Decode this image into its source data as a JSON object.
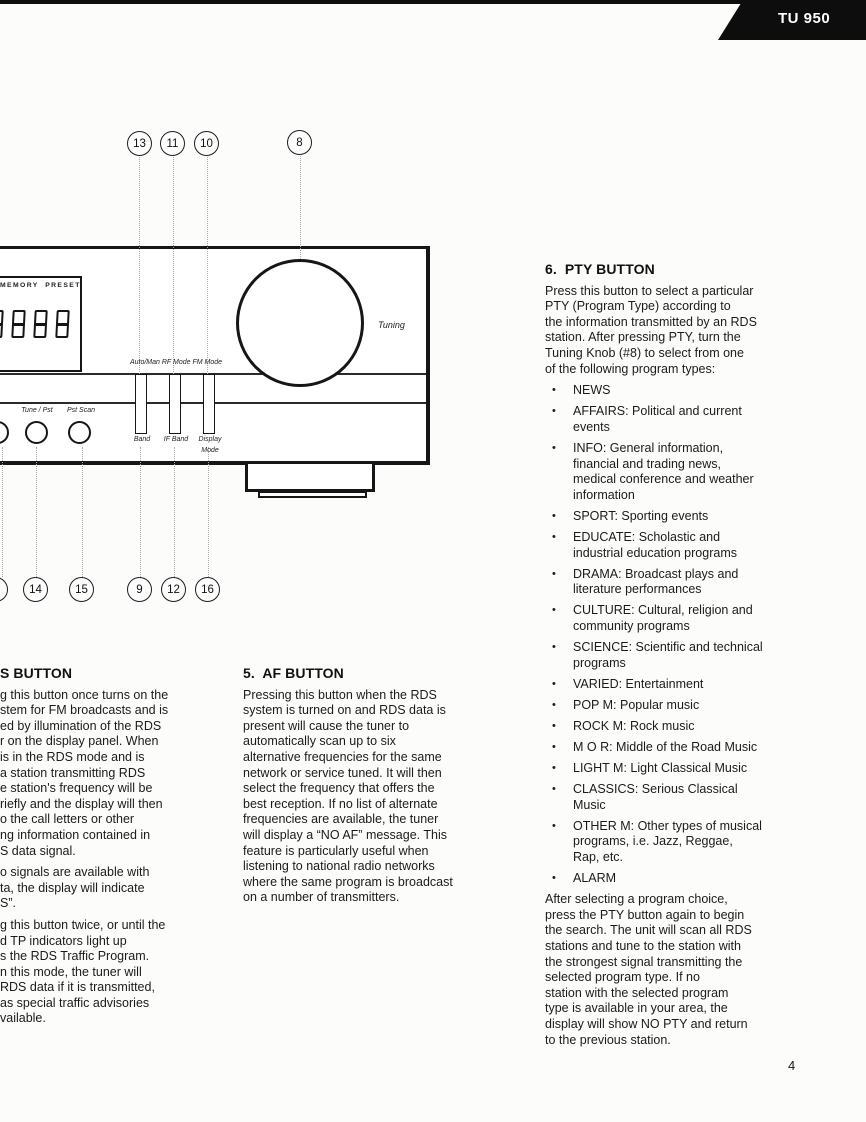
{
  "page": {
    "model_badge": "TU 950",
    "page_number": "4"
  },
  "diagram": {
    "callouts_top": [
      "13",
      "11",
      "10",
      "8"
    ],
    "callouts_bottom": [
      "14",
      "15",
      "9",
      "12",
      "16"
    ],
    "display_panel": {
      "memory_preset": "MEMORY  PRESET",
      "digits": "888"
    },
    "labels": {
      "tuning": "Tuning",
      "auto_man_rf_fm": "Auto/Man RF Mode FM Mode",
      "band": "Band",
      "if_band": "IF Band",
      "display_mode_line1": "Display",
      "display_mode_line2": "Mode",
      "tune_pst": "Tune / Pst",
      "pst_scan": "Pst Scan"
    }
  },
  "sections": {
    "rds_button": {
      "heading": "S BUTTON",
      "paragraphs": [
        [
          "g this button once turns on the",
          "stem for FM broadcasts and is",
          "ed by illumination of the RDS",
          "r on the display panel. When",
          "is in the RDS mode and is",
          "a station transmitting RDS",
          "e station's frequency will be",
          "riefly and the display will then",
          "o the call letters or other",
          "ng information contained in",
          "S data signal."
        ],
        [
          "o signals are available with",
          "ta, the display will indicate",
          "S”."
        ],
        [
          "g this button twice, or until the",
          "d TP indicators light up",
          "s the RDS Traffic Program.",
          "n this mode, the tuner will",
          "RDS data if it is transmitted,",
          "as special traffic advisories",
          "vailable."
        ]
      ]
    },
    "af_button": {
      "heading": "5.  AF BUTTON",
      "lines": [
        "Pressing this button when the RDS",
        "system is turned on and RDS data is",
        "present will cause the tuner to",
        "automatically scan up to six",
        "alternative frequencies for the same",
        "network or service tuned. It will then",
        "select the frequency that offers the",
        "best reception. If no list of alternate",
        "frequencies are available, the tuner",
        "will display a “NO AF” message. This",
        "feature is particularly useful when",
        "listening to national radio networks",
        "where the same program is broadcast",
        "on a number of transmitters."
      ]
    },
    "pty_button": {
      "heading": "6.  PTY BUTTON",
      "intro_lines": [
        "Press this button to select a particular",
        "PTY (Program Type) according to",
        "the information transmitted by an RDS",
        "station. After pressing PTY, turn the",
        "Tuning Knob (#8) to select from one",
        "of the following program types:"
      ],
      "bullets": [
        {
          "lines": [
            "NEWS"
          ]
        },
        {
          "lines": [
            "AFFAIRS: Political and current",
            "events"
          ]
        },
        {
          "lines": [
            "INFO: General information,",
            "financial and trading news,",
            "medical conference and weather",
            "information"
          ]
        },
        {
          "lines": [
            "SPORT: Sporting events"
          ]
        },
        {
          "lines": [
            "EDUCATE: Scholastic and",
            "industrial education programs"
          ]
        },
        {
          "lines": [
            "DRAMA: Broadcast plays and",
            "literature performances"
          ]
        },
        {
          "lines": [
            "CULTURE: Cultural, religion and",
            "community programs"
          ]
        },
        {
          "lines": [
            "SCIENCE: Scientific and technical",
            "programs"
          ]
        },
        {
          "lines": [
            "VARIED: Entertainment"
          ]
        },
        {
          "lines": [
            "POP M: Popular music"
          ]
        },
        {
          "lines": [
            "ROCK M: Rock music"
          ]
        },
        {
          "lines": [
            "M O R: Middle of the Road Music"
          ]
        },
        {
          "lines": [
            "LIGHT M: Light Classical Music"
          ]
        },
        {
          "lines": [
            "CLASSICS: Serious Classical",
            "Music"
          ]
        },
        {
          "lines": [
            "OTHER M: Other types of musical",
            "programs, i.e. Jazz, Reggae,",
            "Rap, etc."
          ]
        },
        {
          "lines": [
            "ALARM"
          ]
        }
      ],
      "outro_lines": [
        "After selecting a program choice,",
        "press the PTY button again to begin",
        "the search. The unit will scan all RDS",
        "stations and tune to the station with",
        "the strongest signal transmitting the",
        "selected program type. If no",
        "station with the selected program",
        "type is available in your area, the",
        "display will show NO PTY and return",
        "to the previous station."
      ]
    }
  }
}
